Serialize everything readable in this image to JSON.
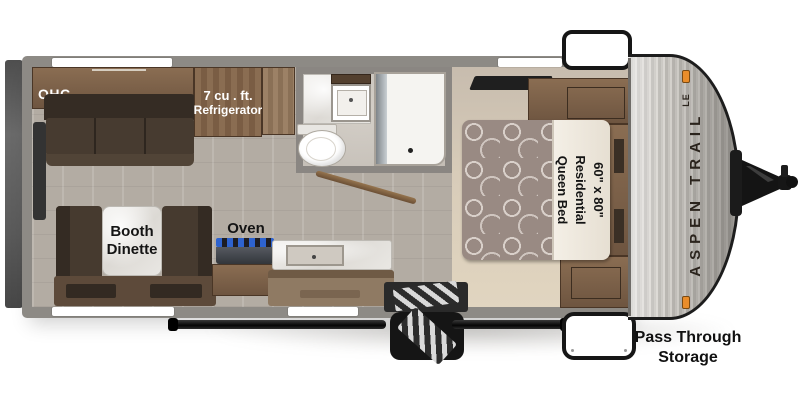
{
  "labels": {
    "ohc": "OHC",
    "refrigerator": {
      "line1": "7 cu . ft.",
      "line2": "Refrigerator"
    },
    "dinette": {
      "line1": "Booth",
      "line2": "Dinette"
    },
    "oven": "Oven",
    "bed": {
      "line1": "60\" x 80\"",
      "line2": "Residential",
      "line3": "Queen Bed"
    },
    "storage": {
      "line1": "Pass Through",
      "line2": "Storage"
    },
    "brand": {
      "name": "ASPEN TRAIL",
      "edition": "LE"
    }
  },
  "features": [
    "rear-bumper",
    "overhead-cabinet",
    "sofa",
    "refrigerator",
    "pantry-cabinet",
    "bathroom-vanity",
    "bathroom-sink",
    "toilet",
    "shower",
    "bathroom-door",
    "roof-vent",
    "queen-bed",
    "wardrobe-front-top",
    "wardrobe-front-bottom",
    "booth-dinette",
    "stove-oven",
    "kitchen-counter",
    "kitchen-sink",
    "entry-step-well",
    "fold-out-entry-steps",
    "awning-rail",
    "pass-through-hatch-top",
    "pass-through-hatch-bottom",
    "front-cap",
    "marker-lights",
    "tongue-a-frame-jack"
  ],
  "colors": {
    "background": "#ffffff",
    "wall_gray": "#8d8a85",
    "floor_main": "#b3aca3",
    "floor_bedroom": "#d8ccb9",
    "floor_bath": "#cbc5be",
    "wood_cabinet": "#7b5f46",
    "sofa_brown": "#40352b",
    "mattress_mauve": "#998a83",
    "marble_white": "#eceae6",
    "burner_blue": "#2e63cf",
    "marker_orange": "#ea8d2b",
    "chassis_black": "#151515",
    "cap_silver": "#c2bfba",
    "label_text": "#141414"
  }
}
